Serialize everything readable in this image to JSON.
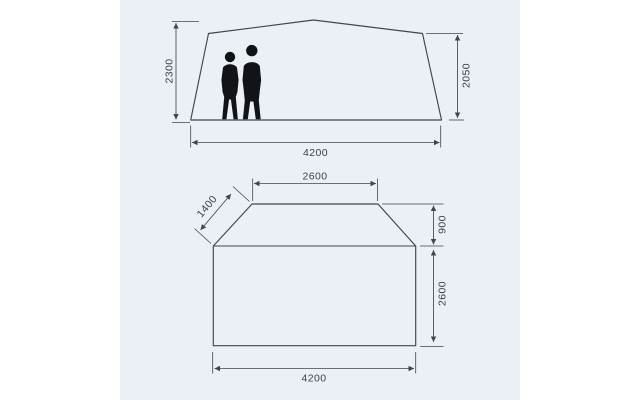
{
  "colors": {
    "page": "#ffffff",
    "panel": "#eaf0f6",
    "line": "#3f464d",
    "text": "#3a4046",
    "silhouette": "#111317"
  },
  "elevation_view": {
    "peak_height": "2300",
    "wall_height": "2050",
    "base_width": "4200"
  },
  "floorplan_view": {
    "front_edge_width": "2600",
    "side_panel_length": "1400",
    "front_section_depth": "900",
    "main_section_depth": "2600",
    "total_width": "4200"
  }
}
